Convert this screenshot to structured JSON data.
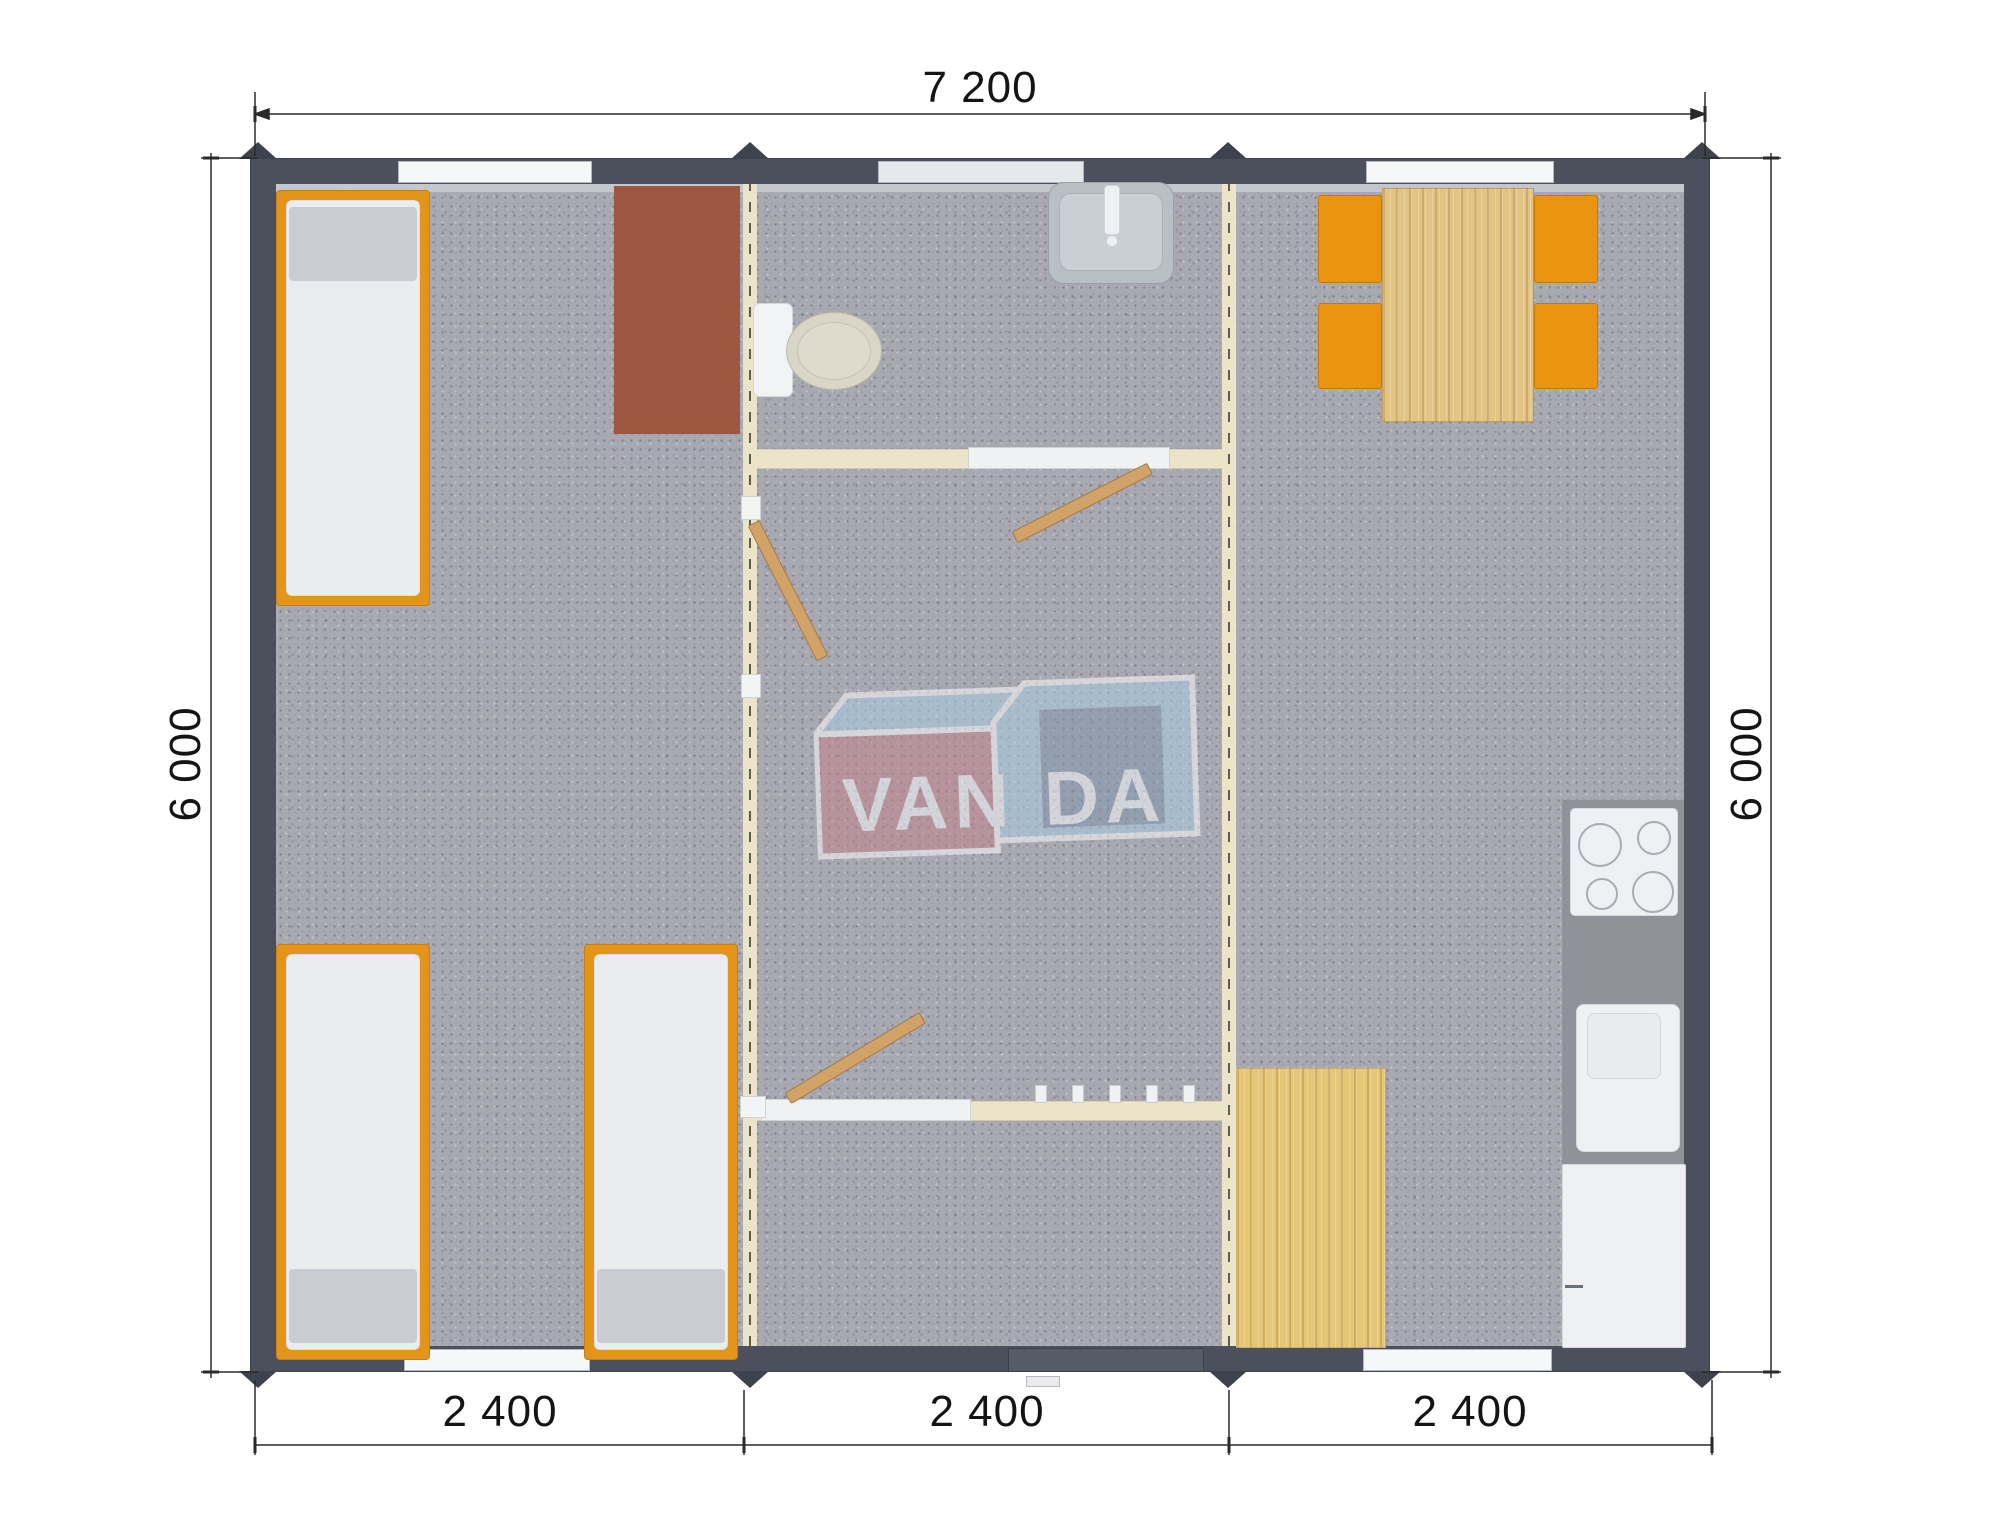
{
  "dimensions": {
    "width_label": "7 200",
    "height_label_left": "6 000",
    "height_label_right": "6 000",
    "module_labels": [
      "2 400",
      "2 400",
      "2 400"
    ]
  },
  "logo": {
    "full": "VANDA",
    "text_left": "VAN",
    "text_right": "DA"
  },
  "colors": {
    "wall": "#4b505c",
    "carpet": "#a9a9b2",
    "partition_cream": "#ebe4c9",
    "bed_frame_orange": "#e3941b",
    "mattress_white": "#eaeced",
    "pillow_gray": "#c9cdd2",
    "wardrobe_brown": "#9d5741",
    "wood_light": "#e2c484",
    "chair_orange": "#ea9410",
    "counter_gray": "#8f9298",
    "appliance_white": "#eef0f3",
    "door_wood": "#d2a368",
    "logo_red": "#c5808c",
    "logo_light_blue": "#aacfe2",
    "logo_dark_blue": "#8096ad"
  }
}
